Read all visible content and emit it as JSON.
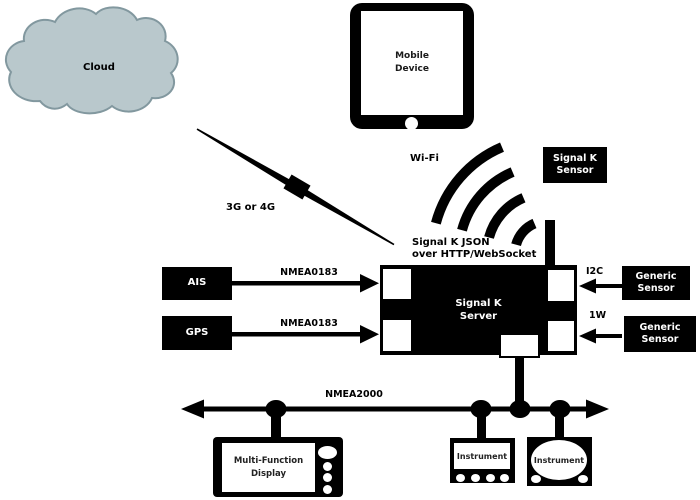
{
  "labels": {
    "cloud": "Cloud",
    "mobile_device": "Mobile\nDevice",
    "wifi": "Wi-Fi",
    "cellular": "3G or 4G",
    "signalk_sensor": "Signal K\nSensor",
    "protocol_note": "Signal K JSON\nover HTTP/WebSocket",
    "ais": "AIS",
    "gps": "GPS",
    "nmea0183_ais": "NMEA0183",
    "nmea0183_gps": "NMEA0183",
    "server": "Signal K\nServer",
    "i2c": "I2C",
    "one_wire": "1W",
    "generic_sensor_i2c": "Generic\nSensor",
    "generic_sensor_1w": "Generic\nSensor",
    "nmea2000": "NMEA2000",
    "mfd": "Multi-Function\nDisplay",
    "instrument_square": "Instrument",
    "instrument_round": "Instrument"
  },
  "colors": {
    "ink": "#000000",
    "surface": "#ffffff",
    "cloud_fill": "#b9c8cc",
    "cloud_stroke": "#82989f"
  }
}
